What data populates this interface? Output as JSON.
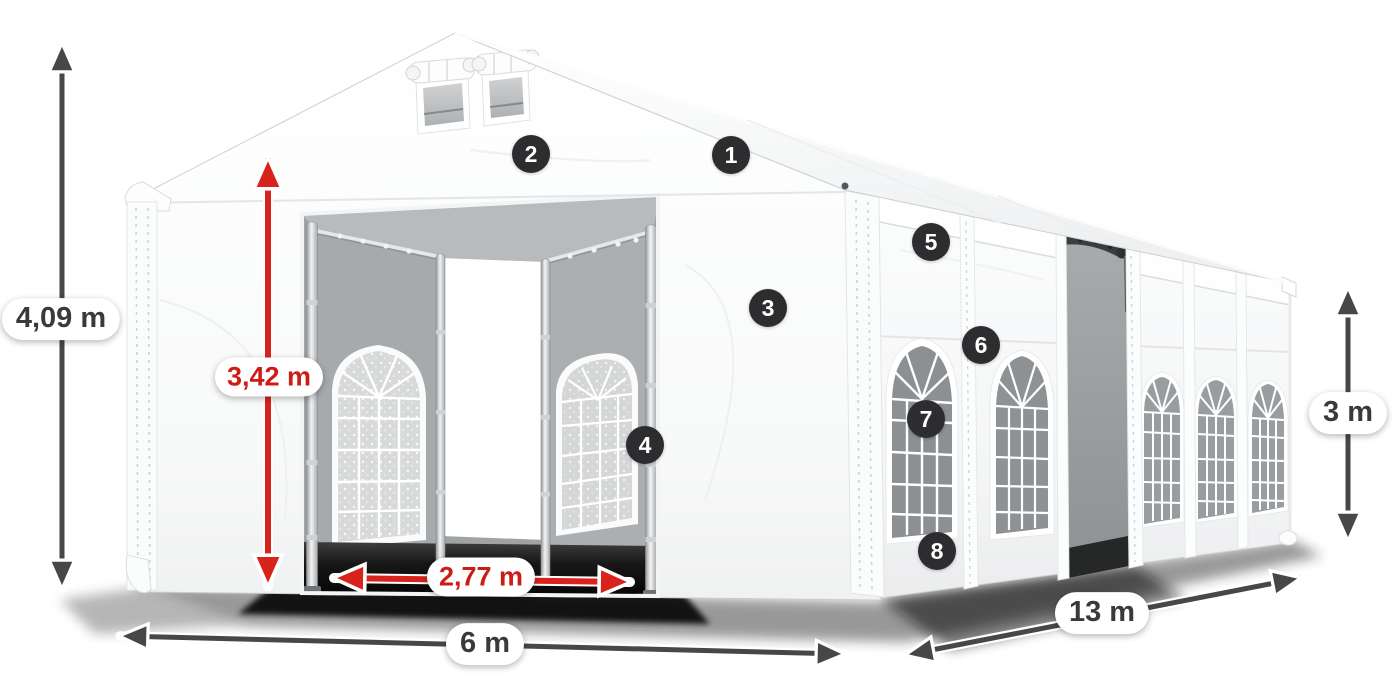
{
  "dimensions": {
    "total_height": {
      "value": "4,09 m",
      "style": "gray"
    },
    "entrance_height": {
      "value": "3,42 m",
      "style": "red"
    },
    "entrance_width": {
      "value": "2,77 m",
      "style": "red"
    },
    "front_width": {
      "value": "6 m",
      "style": "gray"
    },
    "side_length": {
      "value": "13 m",
      "style": "gray"
    },
    "side_height": {
      "value": "3 m",
      "style": "gray"
    }
  },
  "markers": [
    {
      "number": "1"
    },
    {
      "number": "2"
    },
    {
      "number": "3"
    },
    {
      "number": "4"
    },
    {
      "number": "5"
    },
    {
      "number": "6"
    },
    {
      "number": "7"
    },
    {
      "number": "8"
    }
  ],
  "colors": {
    "dimension_red_text": "#cd1b16",
    "dimension_gray_text": "#3a3a3c",
    "arrow_gray": "#474749",
    "arrow_red": "#d8231d",
    "marker_background": "#2d2d2f",
    "marker_text": "#ffffff",
    "pill_background": "#ffffff",
    "tent_white": "#ffffff",
    "interior_gray": "#a0a3a5",
    "glass_gray": "#8d9092"
  }
}
